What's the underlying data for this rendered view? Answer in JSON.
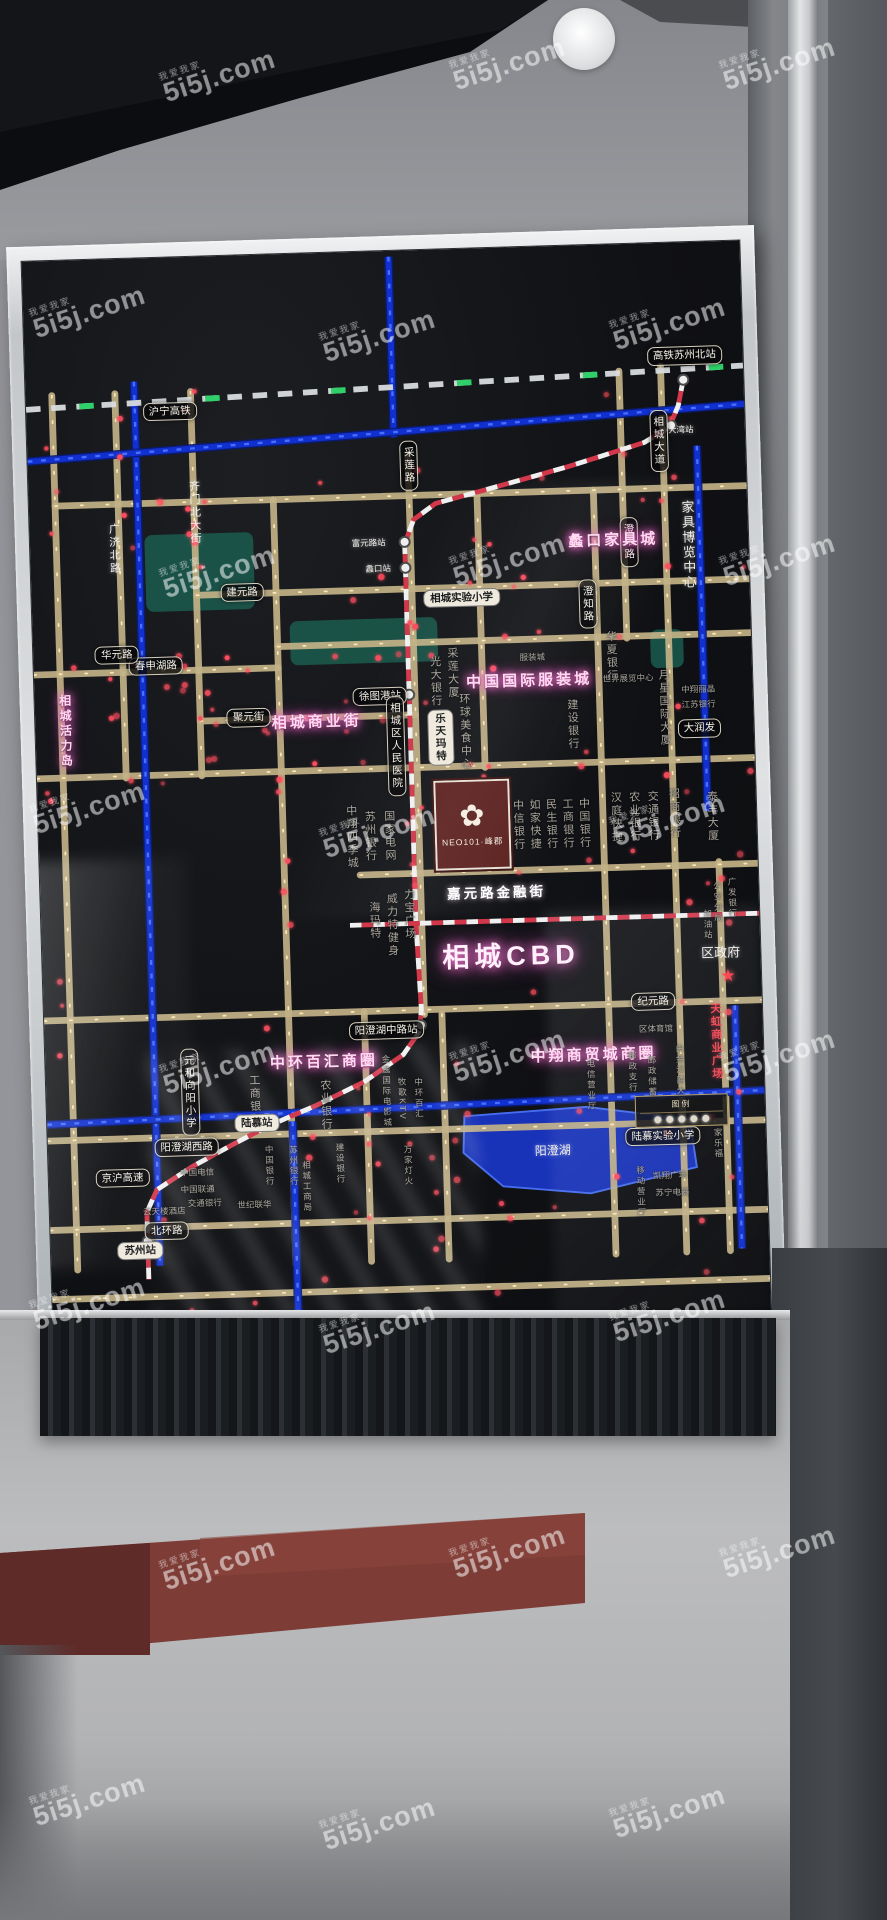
{
  "watermark": {
    "text": "5i5j.com",
    "tag": "我爱我家"
  },
  "board_sign": {
    "area_title": "相城CBD",
    "developer_logo": "NEO101·峰郡",
    "legend_title": "图例"
  },
  "map": {
    "colors": {
      "road": "#c3b287",
      "road_dot": "#ffeab8",
      "river": "#1130cf",
      "river_hi": "#4a74ff",
      "metro_red": "#d2374a",
      "metro_white": "#f0f0f0",
      "rail": "#d9dcde",
      "rail_green": "#2fd06a",
      "led_red": "#ff4d5e",
      "park": "#1c6051",
      "lake": "#1935c6",
      "station_fill": "#efefef",
      "station_ring": "#4a4a4a"
    },
    "roads": {
      "vertical": [
        {
          "x": 27,
          "y1": 140,
          "y2": 1050
        },
        {
          "x": 92,
          "y1": 140,
          "y2": 540
        },
        {
          "x": 170,
          "y1": 140,
          "y2": 540
        },
        {
          "x": 252,
          "y1": 255,
          "y2": 1050
        },
        {
          "x": 392,
          "y1": 212,
          "y2": 795
        },
        {
          "x": 462,
          "y1": 255,
          "y2": 540
        },
        {
          "x": 582,
          "y1": 255,
          "y2": 1050
        },
        {
          "x": 612,
          "y1": 132,
          "y2": 410
        },
        {
          "x": 655,
          "y1": 128,
          "y2": 1050
        },
        {
          "x": 700,
          "y1": 645,
          "y2": 1050
        },
        {
          "x": 330,
          "y1": 790,
          "y2": 1050
        },
        {
          "x": 410,
          "y1": 795,
          "y2": 1050
        }
      ],
      "horizontal": [
        {
          "y": 255,
          "x1": 27,
          "x2": 740
        },
        {
          "y": 352,
          "x1": 170,
          "x2": 740
        },
        {
          "y": 408,
          "x1": 252,
          "x2": 740
        },
        {
          "y": 430,
          "x1": 0,
          "x2": 252
        },
        {
          "y": 483,
          "x1": 170,
          "x2": 392
        },
        {
          "y": 538,
          "x1": 0,
          "x2": 740
        },
        {
          "y": 648,
          "x1": 330,
          "x2": 740
        },
        {
          "y": 790,
          "x1": 0,
          "x2": 740
        },
        {
          "y": 915,
          "x1": 0,
          "x2": 740
        },
        {
          "y": 1008,
          "x1": 0,
          "x2": 740
        },
        {
          "y": 1080,
          "x1": 0,
          "x2": 740
        }
      ]
    },
    "rivers": [
      "M112,128 L112,1048",
      "M378,6 L378,194",
      "M690,212 L690,592",
      "M0,208 L740,170",
      "M0,898 L740,884",
      "M712,795 L712,1048",
      "M253,902 L253,1100"
    ],
    "railway": {
      "path": "M0,154 L740,130",
      "label": "沪宁高铁"
    },
    "metro": {
      "path": "M678,143 L672,170 L662,192 L636,207 L556,230 L468,252 L419,264 L396,280 L386,305 L386,700 L389,790 L386,813 L369,836 L328,863 L278,886 L228,906 L193,923 L148,946 L111,969 L100,992 L100,1062",
      "h_path": "M318,700 L740,700"
    },
    "stations": [
      {
        "x": 678,
        "y": 143
      },
      {
        "x": 664,
        "y": 190
      },
      {
        "x": 386,
        "y": 303
      },
      {
        "x": 386,
        "y": 330
      },
      {
        "x": 386,
        "y": 462
      },
      {
        "x": 388,
        "y": 806
      },
      {
        "x": 228,
        "y": 906
      },
      {
        "x": 100,
        "y": 1022
      }
    ],
    "lake": {
      "points": "430,902 556,896 662,912 668,962 558,986 468,976 428,940"
    },
    "parks": [
      {
        "x": 118,
        "y": 288,
        "w": 112,
        "h": 80
      },
      {
        "x": 265,
        "y": 382,
        "w": 152,
        "h": 46
      },
      {
        "x": 636,
        "y": 402,
        "w": 34,
        "h": 40
      }
    ],
    "neo_logo": {
      "x": 408,
      "y": 552,
      "w": 78,
      "h": 94,
      "flower": "✿"
    },
    "legend": {
      "x": 606,
      "y": 886,
      "w": 96,
      "h": 48
    },
    "star": {
      "x": 706,
      "y": 764
    },
    "labels": [
      {
        "t": "沪宁高铁",
        "x": 148,
        "y": 160,
        "s": "pill"
      },
      {
        "t": "高铁苏州北站",
        "x": 680,
        "y": 118,
        "s": "pill"
      },
      {
        "t": "大湾站",
        "x": 674,
        "y": 196,
        "s": "white",
        "tiny": 1
      },
      {
        "t": "澄阳路",
        "x": 617,
        "y": 310,
        "s": "pill",
        "v": 1
      },
      {
        "t": "采莲路",
        "x": 393,
        "y": 224,
        "s": "pill",
        "v": 1
      },
      {
        "t": "相城大道",
        "x": 651,
        "y": 206,
        "s": "pill",
        "v": 1
      },
      {
        "t": "澄知路",
        "x": 573,
        "y": 373,
        "s": "pill",
        "v": 1,
        "tiny": 1
      },
      {
        "t": "广济北路",
        "x": 86,
        "y": 302,
        "s": "white",
        "v": 1
      },
      {
        "t": "齐门北大街",
        "x": 170,
        "y": 266,
        "s": "white",
        "v": 1
      },
      {
        "t": "富元路站",
        "x": 349,
        "y": 304,
        "s": "white",
        "tiny": 1
      },
      {
        "t": "蠡口站",
        "x": 358,
        "y": 331,
        "s": "white",
        "tiny": 1
      },
      {
        "t": "蠡口家具城",
        "x": 601,
        "y": 308,
        "s": "glow"
      },
      {
        "t": "家具博览中心",
        "x": 677,
        "y": 315,
        "s": "white",
        "v": 1,
        "sz": 13
      },
      {
        "t": "相城实验小学",
        "x": 443,
        "y": 363,
        "s": "pillw"
      },
      {
        "t": "徐图港站",
        "x": 356,
        "y": 463,
        "s": "pill"
      },
      {
        "t": "中国国际服装城",
        "x": 510,
        "y": 451,
        "s": "glow"
      },
      {
        "t": "相城商业街",
        "x": 290,
        "y": 488,
        "s": "glow"
      },
      {
        "t": "建元路",
        "x": 217,
        "y": 350,
        "s": "pill"
      },
      {
        "t": "春申湖路",
        "x": 126,
        "y": 424,
        "s": "pill"
      },
      {
        "t": "聚元街",
        "x": 220,
        "y": 481,
        "s": "pill"
      },
      {
        "t": "华元路",
        "x": 86,
        "y": 412,
        "s": "pill",
        "tiny": 1
      },
      {
        "t": "相城活力岛",
        "x": 30,
        "y": 490,
        "s": "glow",
        "v": 1,
        "sz": 12
      },
      {
        "t": "相城区人民医院",
        "x": 371,
        "y": 515,
        "s": "pill",
        "v": 1,
        "tiny": 1
      },
      {
        "t": "乐天玛特",
        "x": 417,
        "y": 508,
        "s": "pillw",
        "v": 1,
        "tiny": 1
      },
      {
        "t": "环球美食中心",
        "x": 442,
        "y": 502,
        "s": "gray",
        "v": 1
      },
      {
        "t": "光大银行",
        "x": 413,
        "y": 449,
        "s": "gray",
        "v": 1
      },
      {
        "t": "采莲大厦",
        "x": 431,
        "y": 441,
        "s": "gray",
        "v": 1
      },
      {
        "t": "服装城",
        "x": 514,
        "y": 428,
        "s": "gray",
        "tiny": 1
      },
      {
        "t": "华夏银行",
        "x": 595,
        "y": 429,
        "s": "gray",
        "v": 1
      },
      {
        "t": "世界展览中心",
        "x": 612,
        "y": 452,
        "s": "gray",
        "tiny": 1
      },
      {
        "t": "月星国际大厦",
        "x": 648,
        "y": 484,
        "s": "gray",
        "v": 1
      },
      {
        "t": "建设银行",
        "x": 553,
        "y": 498,
        "s": "gray",
        "v": 1
      },
      {
        "t": "江苏银行",
        "x": 684,
        "y": 482,
        "s": "gray",
        "tiny": 1
      },
      {
        "t": "中翔丽晶",
        "x": 684,
        "y": 466,
        "s": "gray",
        "tiny": 1
      },
      {
        "t": "大润发",
        "x": 684,
        "y": 506,
        "s": "pill",
        "tiny": 1
      },
      {
        "t": "泰丰大厦",
        "x": 694,
        "y": 598,
        "s": "gray",
        "v": 1
      },
      {
        "t": "宁波银行",
        "x": 477,
        "y": 601,
        "s": "gray",
        "v": 1
      },
      {
        "t": "中信银行",
        "x": 494,
        "y": 601,
        "s": "gray",
        "v": 1
      },
      {
        "t": "如家快捷",
        "x": 511,
        "y": 601,
        "s": "gray",
        "v": 1
      },
      {
        "t": "民生银行",
        "x": 528,
        "y": 601,
        "s": "gray",
        "v": 1
      },
      {
        "t": "工商银行",
        "x": 545,
        "y": 601,
        "s": "gray",
        "v": 1
      },
      {
        "t": "中国银行",
        "x": 562,
        "y": 601,
        "s": "gray",
        "v": 1
      },
      {
        "t": "汉庭快捷",
        "x": 595,
        "y": 596,
        "s": "gray",
        "v": 1
      },
      {
        "t": "农业银行",
        "x": 614,
        "y": 596,
        "s": "gray",
        "v": 1
      },
      {
        "t": "交通银行",
        "x": 633,
        "y": 596,
        "s": "gray",
        "v": 1
      },
      {
        "t": "招商银行",
        "x": 655,
        "y": 594,
        "s": "gray",
        "v": 1
      },
      {
        "t": "苏州银行",
        "x": 341,
        "y": 608,
        "s": "gray",
        "v": 1
      },
      {
        "t": "国家电网",
        "x": 361,
        "y": 608,
        "s": "gray",
        "v": 1
      },
      {
        "t": "中翔四季城",
        "x": 322,
        "y": 608,
        "s": "gray",
        "v": 1
      },
      {
        "t": "嘉元路金融街",
        "x": 470,
        "y": 671,
        "s": "whiteb"
      },
      {
        "t": "力宝广场",
        "x": 379,
        "y": 691,
        "s": "gray",
        "v": 1
      },
      {
        "t": "威力特健身",
        "x": 361,
        "y": 701,
        "s": "gray",
        "v": 1
      },
      {
        "t": "海玛特",
        "x": 343,
        "y": 696,
        "s": "gray",
        "v": 1
      },
      {
        "t": "相城CBD",
        "x": 483,
        "y": 737,
        "s": "cbd"
      },
      {
        "t": "区政府",
        "x": 699,
        "y": 741,
        "s": "white",
        "sz": 13
      },
      {
        "t": "公安分局",
        "x": 697,
        "y": 687,
        "s": "gray",
        "v": 1,
        "tiny": 1
      },
      {
        "t": "广发银行",
        "x": 712,
        "y": 683,
        "s": "gray",
        "v": 1,
        "tiny": 1
      },
      {
        "t": "加油站",
        "x": 686,
        "y": 710,
        "s": "gray",
        "v": 1,
        "tiny": 1
      },
      {
        "t": "纪元路",
        "x": 628,
        "y": 788,
        "s": "pill"
      },
      {
        "t": "天虹商业广场",
        "x": 691,
        "y": 832,
        "s": "red",
        "v": 1
      },
      {
        "t": "阳澄湖中路站",
        "x": 352,
        "y": 810,
        "s": "pill"
      },
      {
        "t": "中环百汇商圈",
        "x": 287,
        "y": 841,
        "s": "glow"
      },
      {
        "t": "中翔商贸城商圈",
        "x": 565,
        "y": 842,
        "s": "glow"
      },
      {
        "t": "区体育馆",
        "x": 630,
        "y": 818,
        "s": "gray",
        "tiny": 1
      },
      {
        "t": "元和向阳小学",
        "x": 148,
        "y": 869,
        "s": "pill",
        "v": 1,
        "tiny": 1
      },
      {
        "t": "工商银行",
        "x": 214,
        "y": 879,
        "s": "gray",
        "v": 1
      },
      {
        "t": "农业银行",
        "x": 287,
        "y": 886,
        "s": "gray",
        "v": 1
      },
      {
        "t": "金逸国际电影城",
        "x": 350,
        "y": 874,
        "s": "gray",
        "v": 1,
        "tiny": 1
      },
      {
        "t": "牧歌KTV",
        "x": 366,
        "y": 882,
        "s": "gray",
        "v": 1,
        "tiny": 1
      },
      {
        "t": "中环百汇",
        "x": 383,
        "y": 882,
        "s": "gray",
        "v": 1,
        "tiny": 1
      },
      {
        "t": "电信营业厅",
        "x": 561,
        "y": 874,
        "s": "gray",
        "v": 1,
        "tiny": 1
      },
      {
        "t": "邮政支行",
        "x": 604,
        "y": 861,
        "s": "gray",
        "v": 1,
        "tiny": 1
      },
      {
        "t": "邮政储蓄",
        "x": 624,
        "y": 866,
        "s": "gray",
        "v": 1,
        "tiny": 1
      },
      {
        "t": "白金汉爵大酒店",
        "x": 653,
        "y": 872,
        "s": "gray",
        "v": 1,
        "tiny": 1
      },
      {
        "t": "阳澄湖西路",
        "x": 143,
        "y": 926,
        "s": "pill"
      },
      {
        "t": "陆慕站",
        "x": 216,
        "y": 903,
        "s": "pillw"
      },
      {
        "t": "万家灯火",
        "x": 370,
        "y": 952,
        "s": "gray",
        "v": 1,
        "tiny": 1
      },
      {
        "t": "相城工商局",
        "x": 265,
        "y": 970,
        "s": "gray",
        "v": 1,
        "tiny": 1
      },
      {
        "t": "建设银行",
        "x": 300,
        "y": 948,
        "s": "gray",
        "v": 1,
        "tiny": 1
      },
      {
        "t": "中国银行",
        "x": 227,
        "y": 948,
        "s": "gray",
        "v": 1,
        "tiny": 1
      },
      {
        "t": "苏州银行",
        "x": 252,
        "y": 949,
        "s": "gray",
        "v": 1,
        "tiny": 1
      },
      {
        "t": "世纪联华",
        "x": 211,
        "y": 988,
        "s": "gray",
        "tiny": 1
      },
      {
        "t": "中国电信",
        "x": 153,
        "y": 953,
        "s": "gray",
        "tiny": 1
      },
      {
        "t": "中国联通",
        "x": 153,
        "y": 970,
        "s": "gray",
        "tiny": 1
      },
      {
        "t": "交通银行",
        "x": 160,
        "y": 985,
        "s": "gray",
        "tiny": 1
      },
      {
        "t": "云天楼酒店",
        "x": 118,
        "y": 992,
        "s": "gray",
        "tiny": 1
      },
      {
        "t": "陆慕实验小学",
        "x": 634,
        "y": 929,
        "s": "pill",
        "tiny": 1
      },
      {
        "t": "家乐福",
        "x": 690,
        "y": 938,
        "s": "gray",
        "v": 1,
        "tiny": 1
      },
      {
        "t": "移动营业厅",
        "x": 609,
        "y": 986,
        "s": "gray",
        "v": 1,
        "tiny": 1
      },
      {
        "t": "凯翔广场",
        "x": 640,
        "y": 970,
        "s": "gray",
        "tiny": 1
      },
      {
        "t": "苏宁电器",
        "x": 642,
        "y": 988,
        "s": "gray",
        "tiny": 1
      },
      {
        "t": "阳澄湖",
        "x": 520,
        "y": 941,
        "s": "white",
        "sz": 12
      },
      {
        "t": "京沪高速",
        "x": 76,
        "y": 956,
        "s": "pill",
        "tiny": 1
      },
      {
        "t": "北环路",
        "x": 120,
        "y": 1012,
        "s": "pill",
        "tiny": 1
      },
      {
        "t": "苏州站",
        "x": 92,
        "y": 1032,
        "s": "pillw"
      }
    ]
  }
}
